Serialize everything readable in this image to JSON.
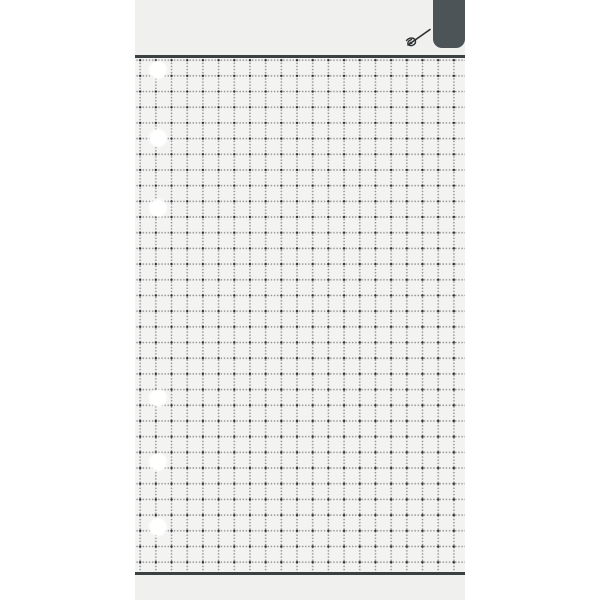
{
  "page": {
    "kind": "blank dotted-grid organizer page",
    "text_content": ""
  },
  "header": {
    "tab": {
      "name": "divider-tab",
      "label": ""
    },
    "pen_icon": "pen-icon"
  },
  "colors": {
    "canvas_bg": "#ffffff",
    "page_bg": "#f0f0ef",
    "paper_bg": "#f3f3f2",
    "rule": "#3b4043",
    "tab": "#4d5458",
    "grid_dot_major": "rgba(32,35,37,0.9)",
    "grid_dot_minor": "rgba(55,58,60,0.5)",
    "pen_icon_stroke": "#2c2f31",
    "hole": "#ffffff"
  },
  "grid": {
    "cell_px": 15.7,
    "dot_step_px": 3.14,
    "offset_x_px": 13,
    "offset_y_px": 10
  },
  "holes": {
    "count": 6,
    "diameter_px": 16,
    "center_x_px": 23,
    "center_y_px": [
      70,
      138,
      208,
      398,
      462,
      527
    ]
  }
}
